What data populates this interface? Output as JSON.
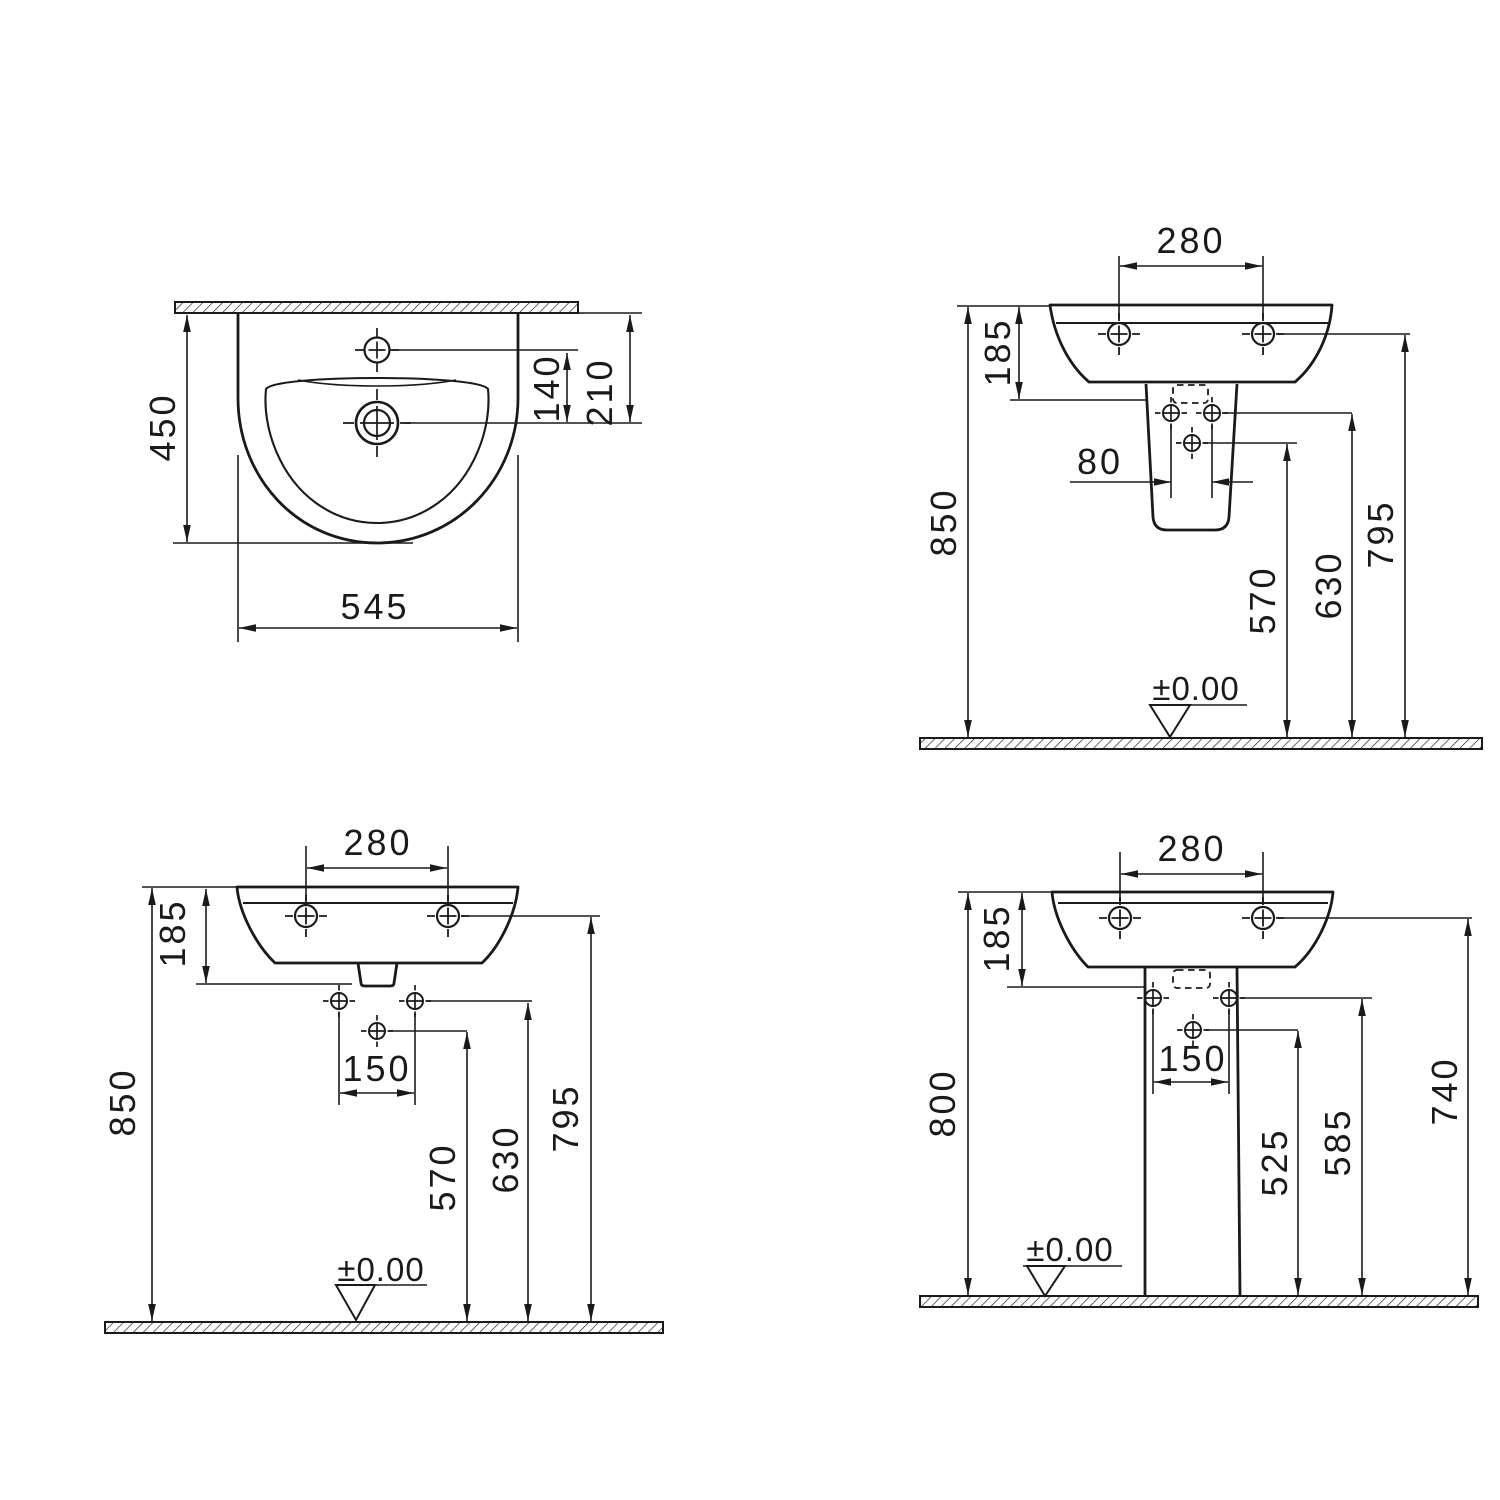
{
  "page": {
    "background": "#ffffff",
    "line_color": "#1a1a1a",
    "kind": "washbasin installation technical drawing"
  },
  "views": {
    "top_view": {
      "label": "basin top view",
      "depth": "450",
      "width": "545",
      "tap_hole_to_drain": "140",
      "wall_to_drain": "210"
    },
    "front_semi_pedestal": {
      "label": "front view with semi-pedestal",
      "tap_hole_spacing": "280",
      "rim_to_underside": "185",
      "fixing_hole_spacing": "80",
      "rim_height": "850",
      "inlet_height": "570",
      "fixing_height": "630",
      "bolt_height": "795",
      "datum": "±0.00"
    },
    "front_wall_hung": {
      "label": "front view wall hung",
      "tap_hole_spacing": "280",
      "rim_to_underside": "185",
      "fixing_hole_spacing": "150",
      "rim_height": "850",
      "inlet_height": "570",
      "fixing_height": "630",
      "bolt_height": "795",
      "datum": "±0.00"
    },
    "front_full_pedestal": {
      "label": "front view with full pedestal",
      "tap_hole_spacing": "280",
      "rim_to_underside": "185",
      "fixing_hole_spacing": "150",
      "rim_height": "800",
      "inlet_height": "525",
      "fixing_height": "585",
      "bolt_height": "740",
      "datum": "±0.00"
    }
  }
}
